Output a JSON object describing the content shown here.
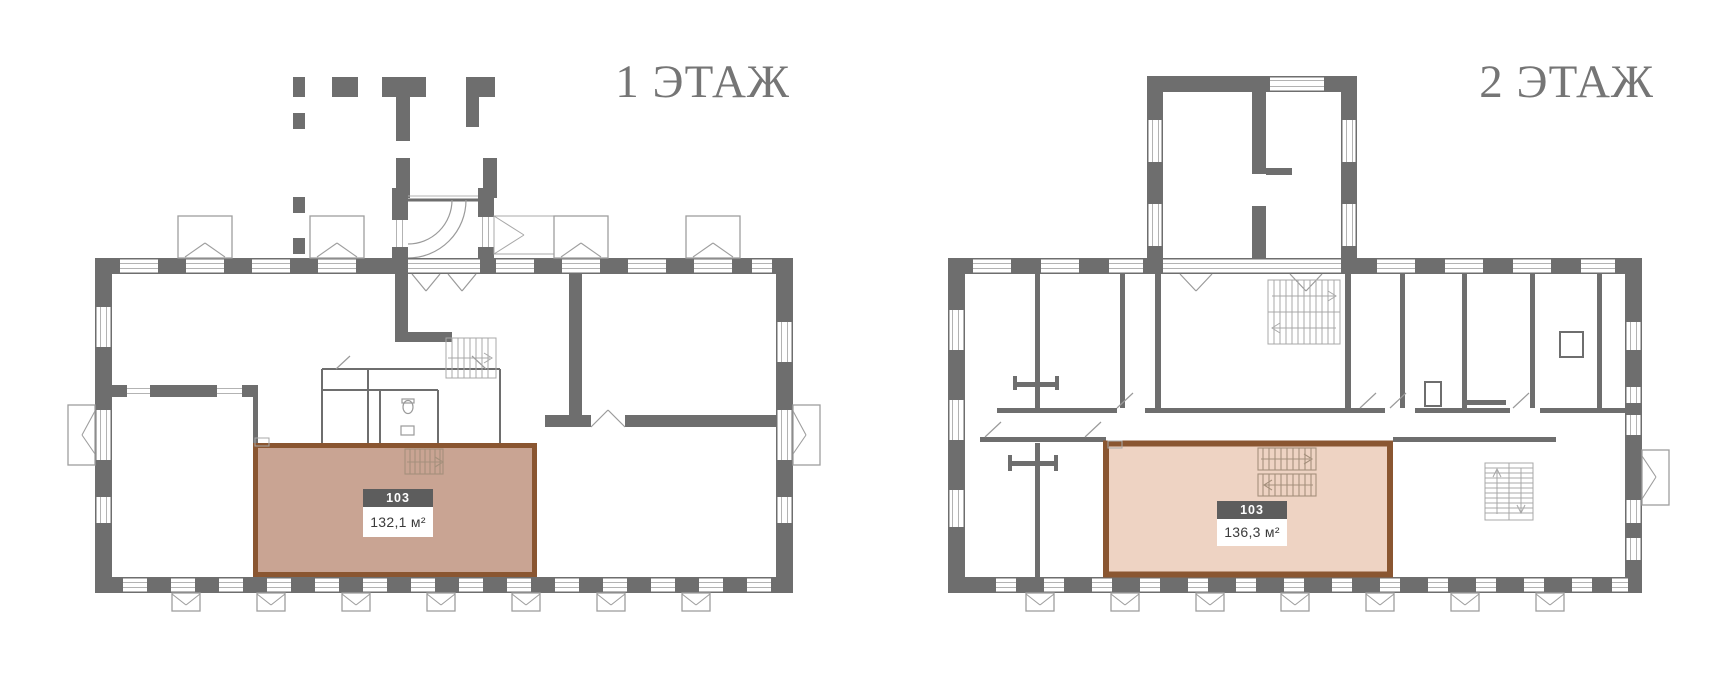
{
  "page": {
    "background": "#ffffff"
  },
  "floors": [
    {
      "id": "floor-1",
      "title": "1 ЭТАЖ",
      "room": {
        "number": "103",
        "area": "132,1 м²"
      }
    },
    {
      "id": "floor-2",
      "title": "2 ЭТАЖ",
      "room": {
        "number": "103",
        "area": "136,3 м²"
      }
    }
  ],
  "colors": {
    "wall": "#6e6e6e",
    "thin_line": "#b3b3b3",
    "floor1_room_fill": "#c9a493",
    "floor2_room_fill": "#eed3c3",
    "room_border": "#8a5631",
    "room_number_bg": "#5d5d5d",
    "room_number_text": "#ffffff",
    "room_area_text": "#3b3b3b",
    "title_text": "#757575"
  }
}
